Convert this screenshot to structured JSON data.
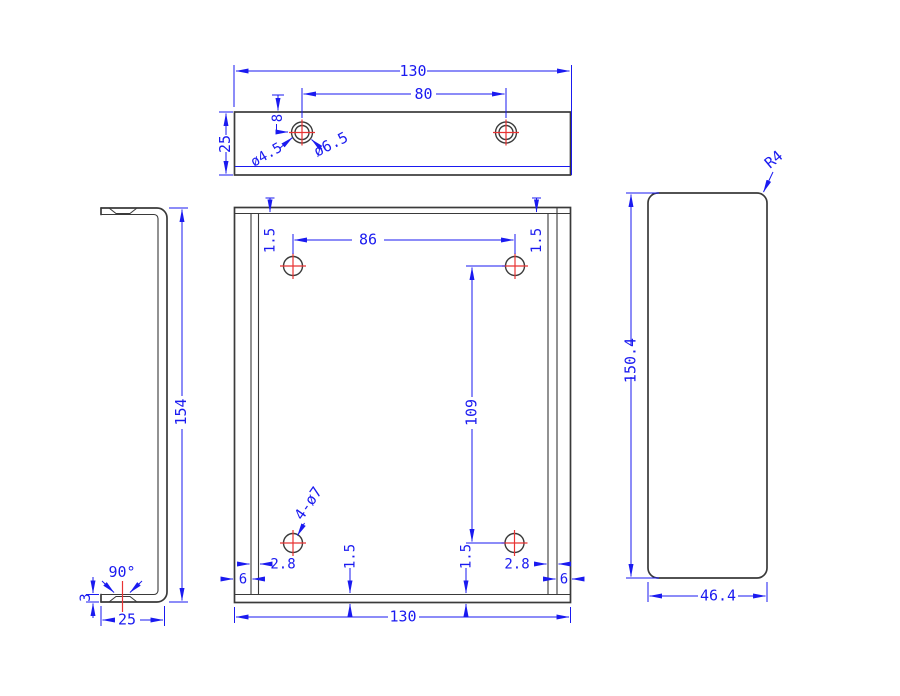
{
  "drawing_type": "cad-orthographic-views",
  "colors": {
    "outline": "#3a3a3a",
    "dimension": "#1a1af0",
    "centerline": "#e83333",
    "background": "#ffffff"
  },
  "views": {
    "top": {
      "label": "top-view",
      "dim_width": "130",
      "dim_hole_spacing": "80",
      "dim_depth": "25",
      "dim_hole_offset": "8",
      "label_hole_inner": "ø4.5",
      "label_hole_outer": "ø6.5"
    },
    "side": {
      "label": "side-view",
      "dim_height": "154",
      "dim_flange_depth": "25",
      "dim_bend_angle": "90°",
      "dim_thickness": "3"
    },
    "front": {
      "label": "front-view",
      "dim_hole_span_x": "86",
      "dim_hole_span_y": "109",
      "label_holes": "4-ø7",
      "dim_top_left": "1.5",
      "dim_top_right": "1.5",
      "dim_bottom_left": "1.5",
      "dim_bottom_right": "1.5",
      "dim_inset_left": "2.8",
      "dim_inset_right": "2.8",
      "dim_edge_left": "6",
      "dim_edge_right": "6",
      "dim_width": "130"
    },
    "profile": {
      "label": "profile-view",
      "dim_height": "150.4",
      "dim_width": "46.4",
      "label_corner_radius": "R4"
    }
  }
}
